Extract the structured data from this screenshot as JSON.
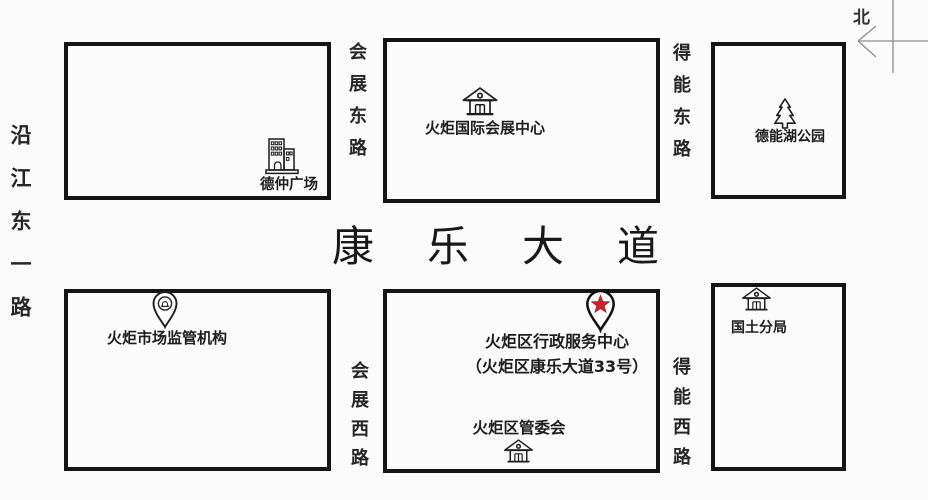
{
  "colors": {
    "background": "#fbfbfb",
    "ink": "#1d1d1d",
    "compass_line": "#8d8d8d",
    "star_red": "#c1272d"
  },
  "compass": {
    "north_label": "北"
  },
  "roads": {
    "yanjiang": {
      "name": "沿江东一路"
    },
    "huizhan_east": {
      "name": "会展东路"
    },
    "dene_east": {
      "name": "得能东路"
    },
    "huizhan_west": {
      "name": "会展西路"
    },
    "dene_west": {
      "name": "得能西路"
    },
    "kangle_avenue": {
      "name": "康乐大道"
    }
  },
  "pois": {
    "dezhong_plaza": {
      "label": "德仲广场",
      "icon": "office-building-icon"
    },
    "exhibition_center": {
      "label": "火炬国际会展中心",
      "icon": "hall-icon"
    },
    "denenghu_park": {
      "label": "德能湖公园",
      "icon": "pine-tree-icon"
    },
    "market_regulator": {
      "label": "火炬市场监管机构",
      "icon": "map-pin-icon"
    },
    "admin_service_center": {
      "label": "火炬区行政服务中心",
      "address": "（火炬区康乐大道33号）",
      "icon": "star-pin-icon"
    },
    "management_committee": {
      "label": "火炬区管委会",
      "icon": "hall-icon"
    },
    "land_bureau": {
      "label": "国土分局",
      "icon": "hall-icon"
    }
  }
}
